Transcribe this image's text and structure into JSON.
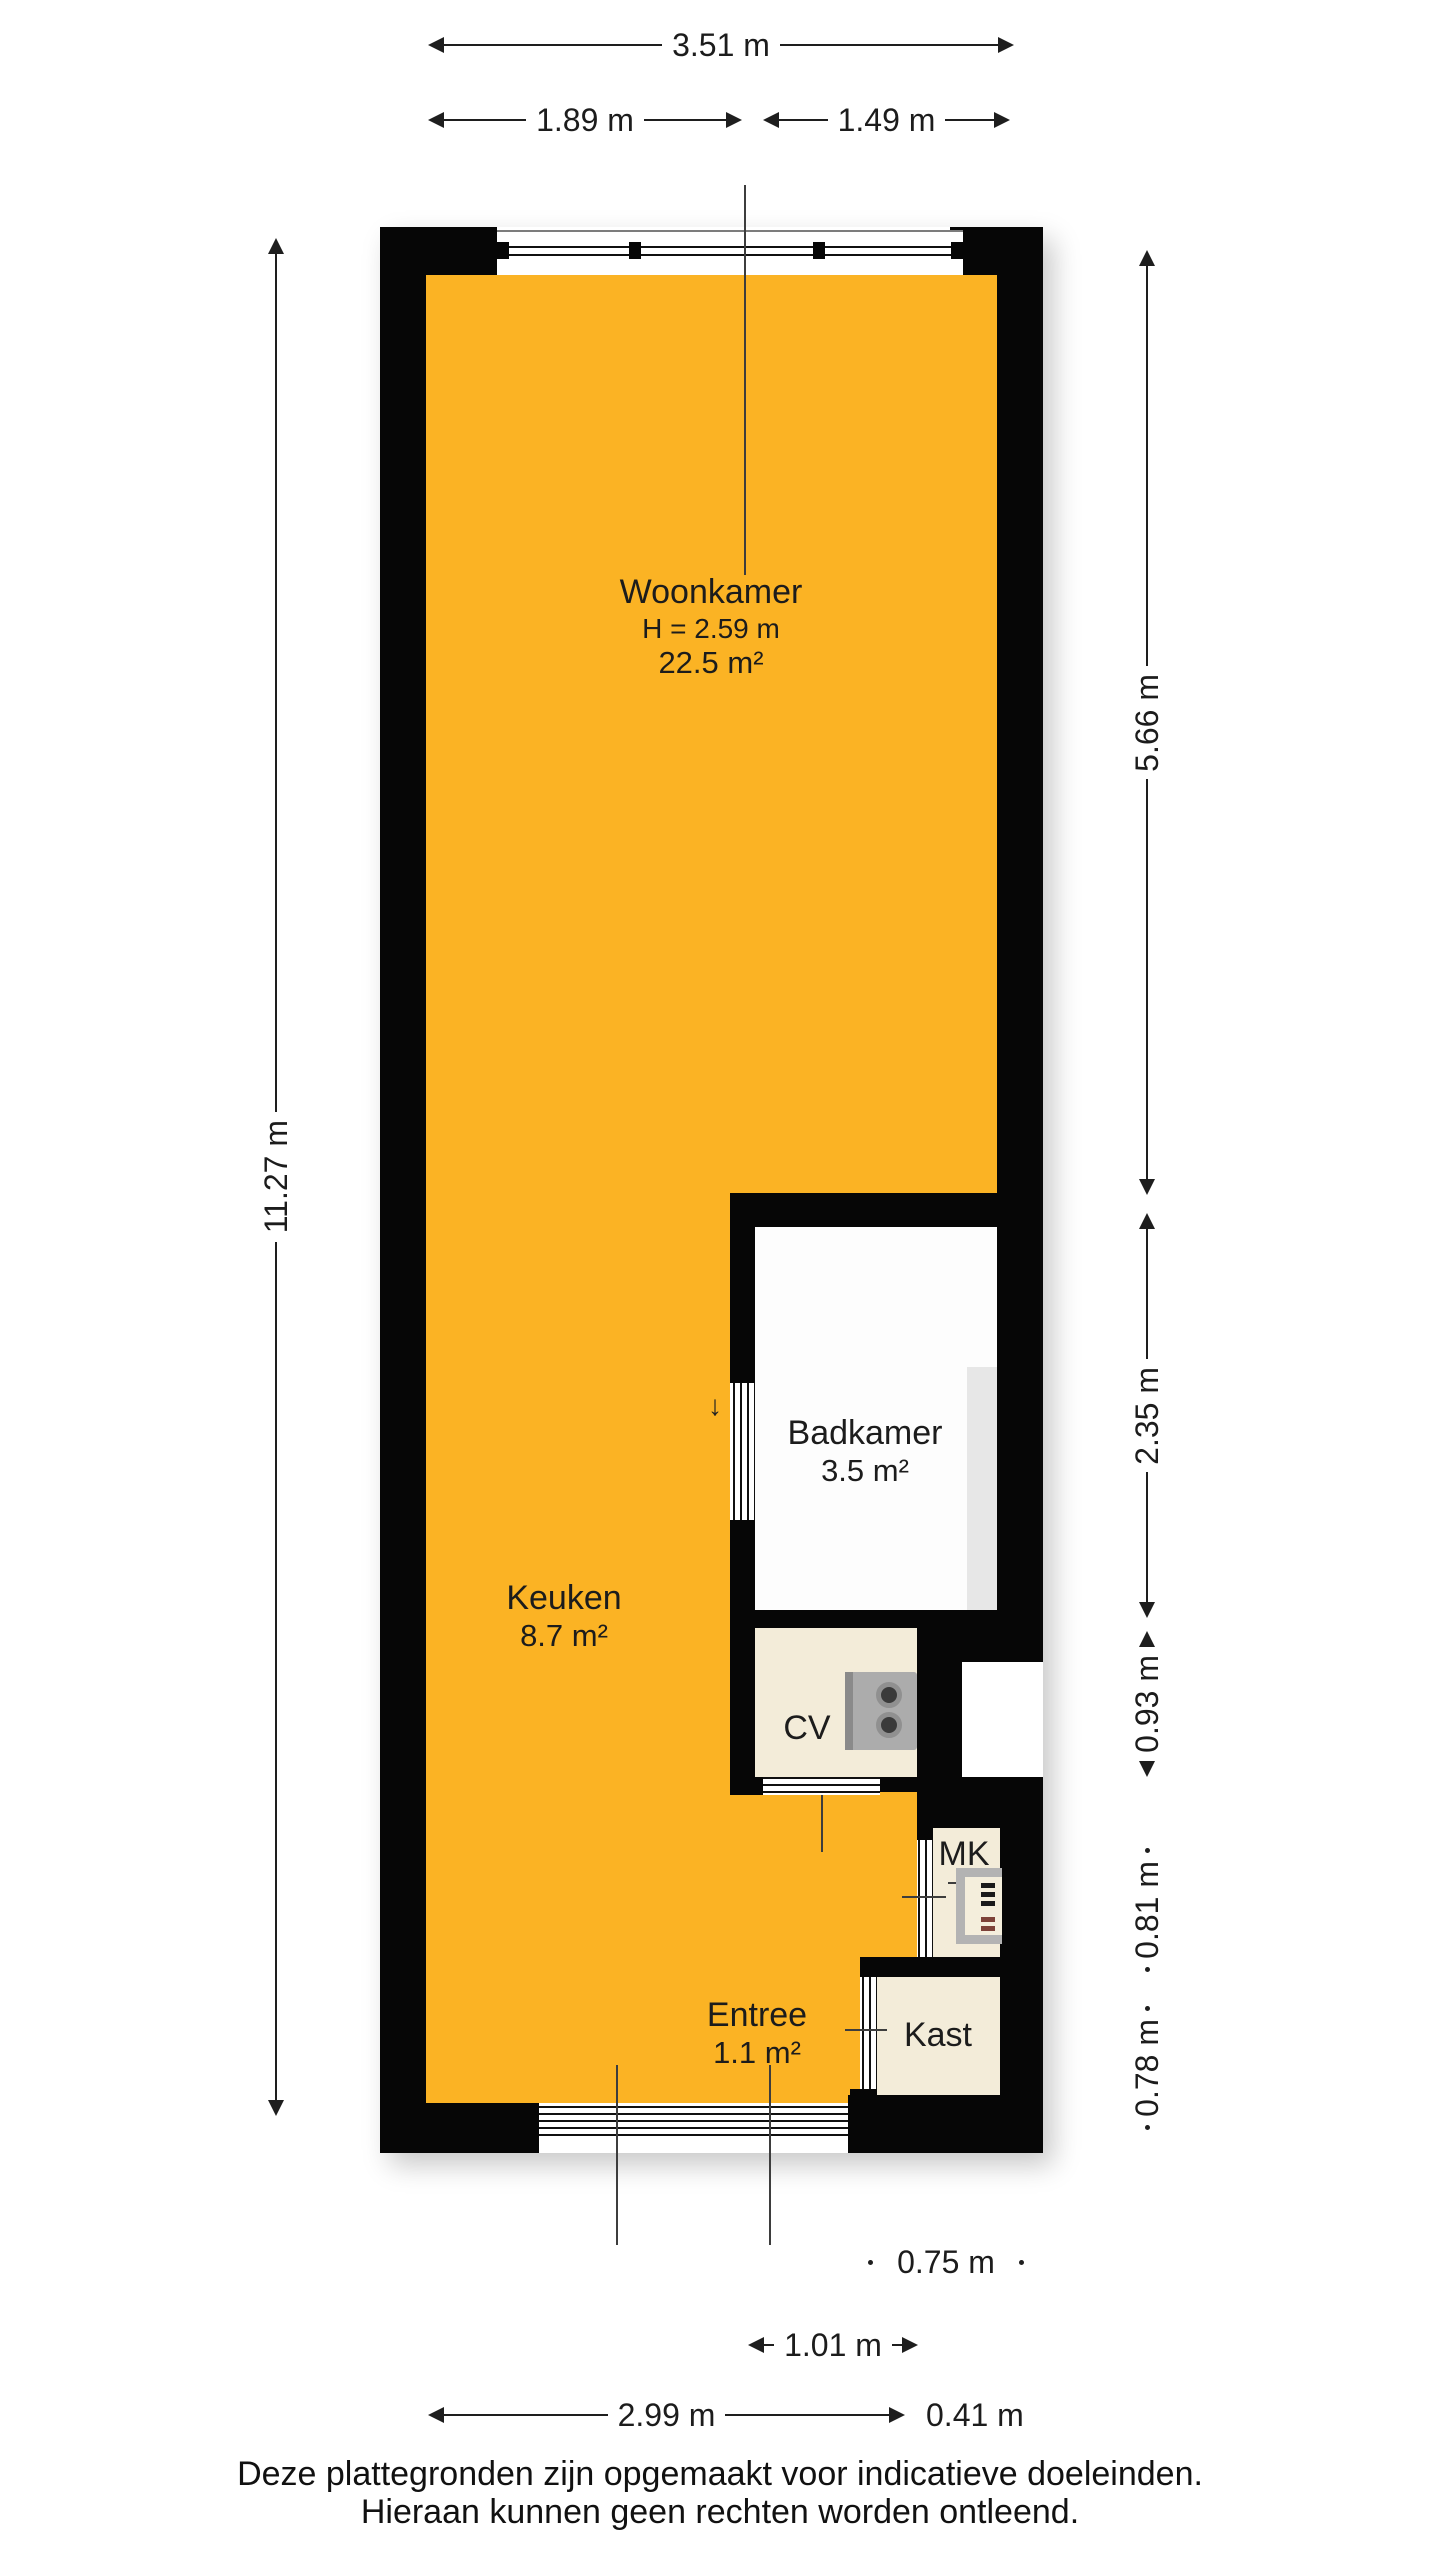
{
  "colors": {
    "floor_orange": "#FBB324",
    "wall_black": "#060606",
    "closet_beige": "#F3ECD9",
    "bathroom_white": "#FDFDFD",
    "shower_gray": "#E7E7E7",
    "appliance_gray": "#ACACAC"
  },
  "rooms": {
    "woonkamer": {
      "label": "Woonkamer",
      "ceiling_height": "H = 2.59 m",
      "area": "22.5 m²"
    },
    "keuken": {
      "label": "Keuken",
      "area": "8.7 m²"
    },
    "badkamer": {
      "label": "Badkamer",
      "area": "3.5 m²"
    },
    "entree": {
      "label": "Entree",
      "area": "1.1 m²"
    },
    "cv": {
      "label": "CV"
    },
    "mk": {
      "label": "MK"
    },
    "kast": {
      "label": "Kast"
    }
  },
  "dimensions": {
    "top_total": "3.51 m",
    "top_left": "1.89 m",
    "top_right": "1.49 m",
    "left_total": "11.27 m",
    "right": [
      "5.66 m",
      "2.35 m",
      "0.93 m",
      "0.81 m",
      "0.78 m"
    ],
    "bottom": [
      "0.75 m",
      "1.01 m",
      "2.99 m",
      "0.41 m"
    ]
  },
  "icons": {
    "door_swing_arrow": "↓"
  },
  "footer": {
    "line1": "Deze plattegronden zijn opgemaakt voor indicatieve doeleinden.",
    "line2": "Hieraan kunnen geen rechten worden ontleend."
  }
}
